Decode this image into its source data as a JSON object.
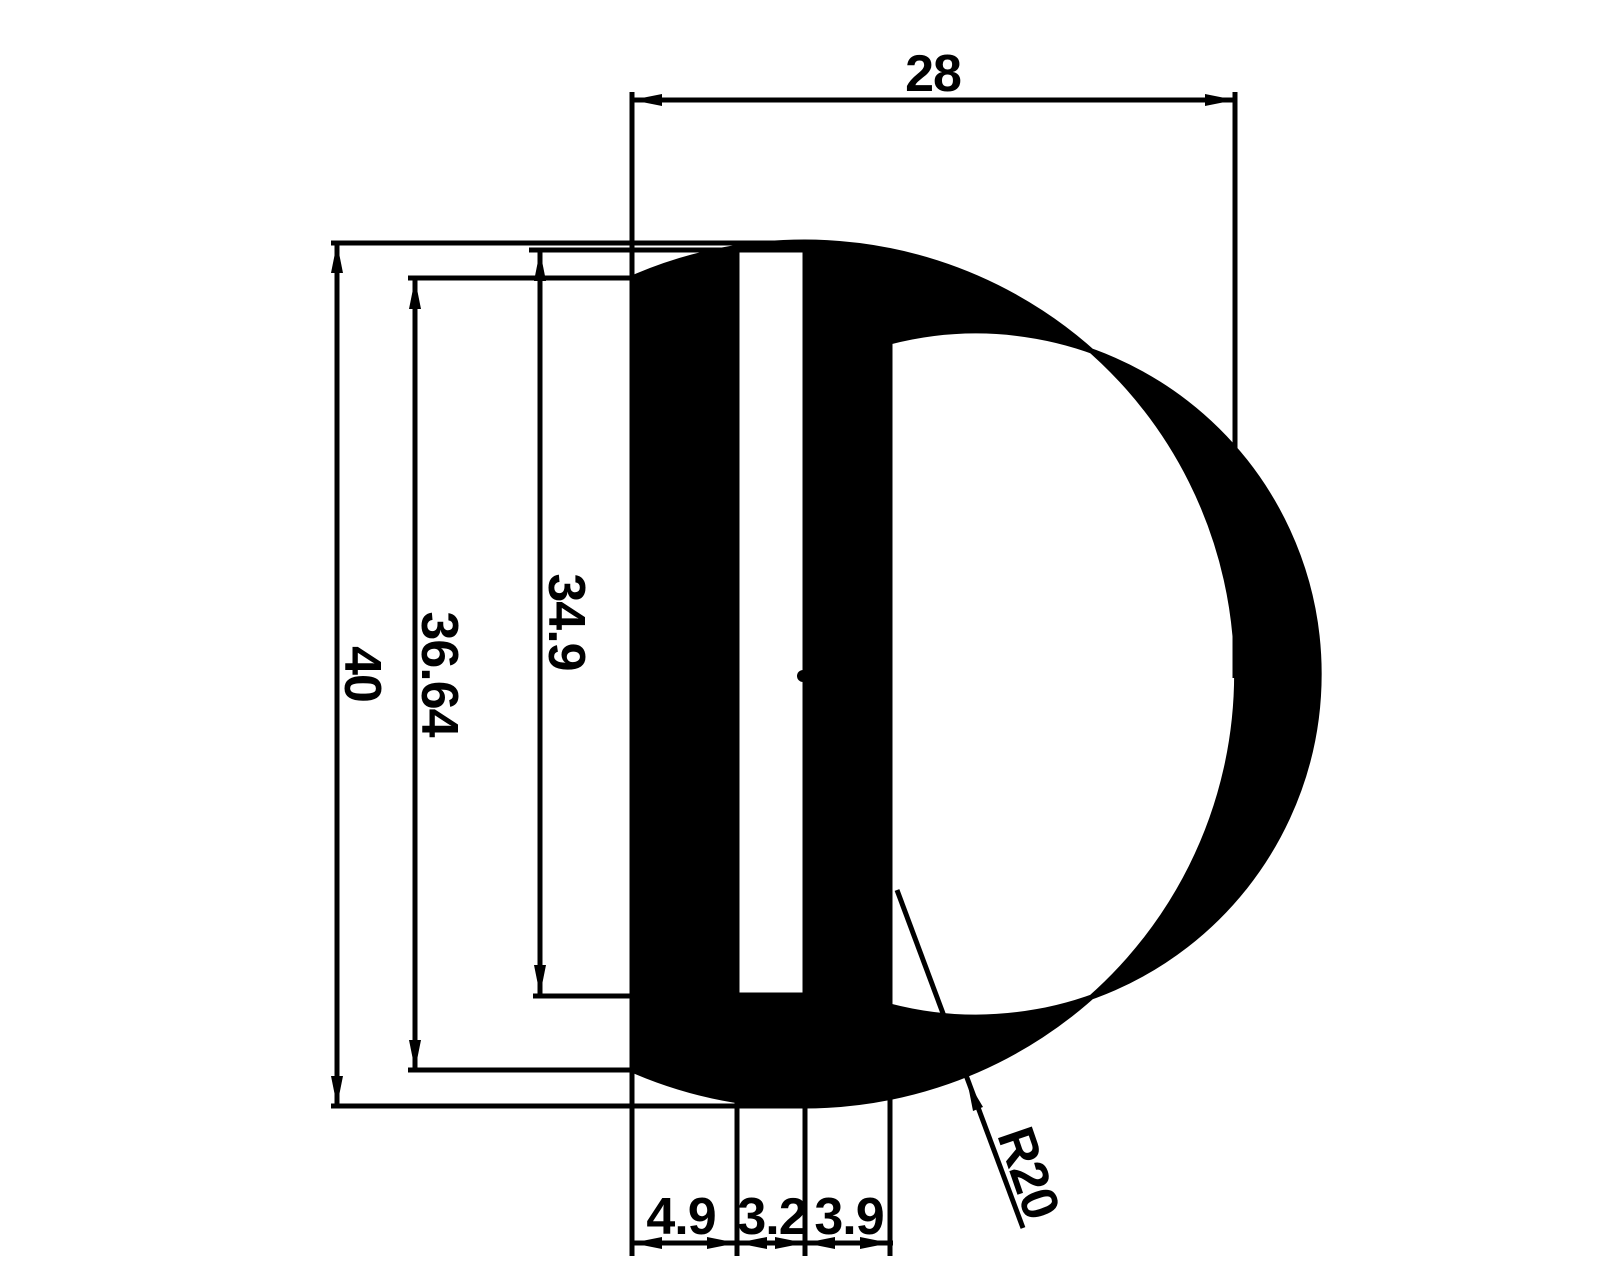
{
  "drawing": {
    "title": "D-profile cross-section drawing",
    "colors": {
      "background": "#ffffff",
      "ink": "#000000"
    },
    "dimensions": {
      "overall_width": "28",
      "overall_height": "40",
      "flat_side_height": "36.64",
      "slot_height": "34.9",
      "left_wall_width": "4.9",
      "slot_width": "3.2",
      "right_wall_width": "3.9",
      "outer_radius": "R20"
    }
  }
}
